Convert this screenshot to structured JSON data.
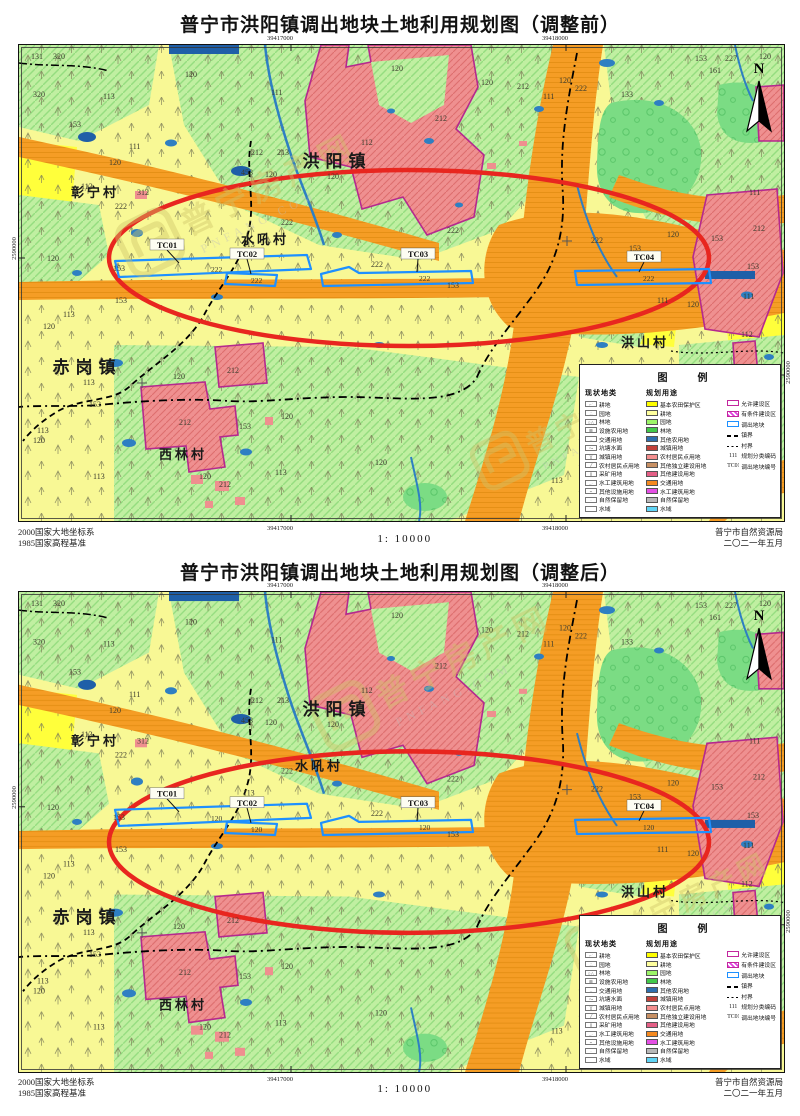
{
  "maps": [
    {
      "title": "普宁市洪阳镇调出地块土地利用规划图（调整前）",
      "variant": "before",
      "plot_label": "222"
    },
    {
      "title": "普宁市洪阳镇调出地块土地利用规划图（调整后）",
      "variant": "after",
      "plot_label": "120"
    }
  ],
  "footer": {
    "datum_line1": "2000国家大地坐标系",
    "datum_line2": "1985国家高程基准",
    "scale": "1:  10000",
    "agency_line1": "普宁市自然资源局",
    "agency_line2": "二〇二一年五月"
  },
  "coordinates": {
    "x_left": "39417000",
    "x_right": "39418000",
    "y_label": "2590000"
  },
  "compass": {
    "label": "N"
  },
  "watermark": {
    "cn": "普宁房产网",
    "en": "PNFANG.COM"
  },
  "legend": {
    "title": "图　例",
    "current_header": "现状地类",
    "current_items": [
      {
        "label": "耕地",
        "glyph": "⌐˙"
      },
      {
        "label": "园地",
        "glyph": "∴"
      },
      {
        "label": "林地",
        "glyph": "○△"
      },
      {
        "label": "设施农用地",
        "glyph": "⊞"
      },
      {
        "label": "交通用地",
        "glyph": "–"
      },
      {
        "label": "坑塘水面",
        "glyph": "〜"
      },
      {
        "label": "城镇用地",
        "glyph": "╳"
      },
      {
        "label": "农村居民点用地",
        "glyph": "╱"
      },
      {
        "label": "采矿用地",
        "glyph": "∥"
      },
      {
        "label": "水工建筑用地",
        "glyph": "–·"
      },
      {
        "label": "其他设施用地",
        "glyph": "⌁"
      },
      {
        "label": "自然保留地",
        "glyph": "·"
      },
      {
        "label": "水域",
        "glyph": ""
      }
    ],
    "planned_header": "规划用途",
    "planned_items": [
      {
        "label": "基本农田保护区",
        "color": "#ffff00"
      },
      {
        "label": "耕地",
        "color": "#ffff9e"
      },
      {
        "label": "园地",
        "color": "#9cf468"
      },
      {
        "label": "林地",
        "color": "#42c94a"
      },
      {
        "label": "其他农用地",
        "color": "#2e6fae"
      },
      {
        "label": "城镇用地",
        "color": "#c2413a"
      },
      {
        "label": "农村居民点用地",
        "color": "#f48f8f"
      },
      {
        "label": "其他独立建设用地",
        "color": "#c79064"
      },
      {
        "label": "其他建设用地",
        "color": "#e45f86"
      },
      {
        "label": "交通用地",
        "color": "#f58a20"
      },
      {
        "label": "水工建筑用地",
        "color": "#e44fe4"
      },
      {
        "label": "自然保留地",
        "color": "#b8b8b8"
      },
      {
        "label": "水域",
        "color": "#5fd4f5"
      }
    ],
    "zone_items": [
      {
        "label": "允许建设区",
        "swatch": "allowed"
      },
      {
        "label": "有条件建设区",
        "swatch": "conditional"
      },
      {
        "label": "调出地块",
        "swatch": "outplot"
      },
      {
        "label": "镇界",
        "swatch": "town-boundary"
      },
      {
        "label": "村界",
        "swatch": "village-boundary"
      },
      {
        "label": "规划分类编码",
        "swatch": "code",
        "code": "111"
      },
      {
        "label": "调出地块编号",
        "swatch": "code",
        "code": "TC01"
      }
    ]
  },
  "map_labels": {
    "towns": [
      {
        "text": "洪阳镇",
        "x": 318,
        "y": 122
      },
      {
        "text": "赤岗镇",
        "x": 68,
        "y": 328
      }
    ],
    "villages": [
      {
        "text": "彰宁村",
        "x": 76,
        "y": 152
      },
      {
        "text": "西林村",
        "x": 164,
        "y": 414
      },
      {
        "text": "洪山村",
        "x": 626,
        "y": 302
      }
    ],
    "shuihou": [
      {
        "text": "水吼村",
        "x": 246,
        "y": 199
      },
      {
        "text": "水吼村",
        "x": 300,
        "y": 177
      }
    ],
    "tc_labels": [
      {
        "text": "TC01",
        "x": 148,
        "y": 202,
        "lx": 160,
        "ly": 218
      },
      {
        "text": "TC02",
        "x": 228,
        "y": 211,
        "lx": 232,
        "ly": 229
      },
      {
        "text": "TC03",
        "x": 399,
        "y": 211,
        "lx": 398,
        "ly": 227
      },
      {
        "text": "TC04",
        "x": 625,
        "y": 214,
        "lx": 620,
        "ly": 227
      }
    ]
  },
  "map_annotations": [
    {
      "t": "131",
      "x": 12,
      "y": 14
    },
    {
      "t": "320",
      "x": 34,
      "y": 14
    },
    {
      "t": "320",
      "x": 14,
      "y": 52
    },
    {
      "t": "113",
      "x": 84,
      "y": 54
    },
    {
      "t": "153",
      "x": 50,
      "y": 82
    },
    {
      "t": "120",
      "x": 166,
      "y": 32
    },
    {
      "t": "111",
      "x": 110,
      "y": 104
    },
    {
      "t": "120",
      "x": 90,
      "y": 120
    },
    {
      "t": "111",
      "x": 252,
      "y": 50
    },
    {
      "t": "120",
      "x": 372,
      "y": 26
    },
    {
      "t": "120",
      "x": 462,
      "y": 40
    },
    {
      "t": "212",
      "x": 498,
      "y": 44
    },
    {
      "t": "111",
      "x": 524,
      "y": 54
    },
    {
      "t": "120",
      "x": 540,
      "y": 38
    },
    {
      "t": "222",
      "x": 556,
      "y": 46
    },
    {
      "t": "133",
      "x": 602,
      "y": 52
    },
    {
      "t": "153",
      "x": 676,
      "y": 16
    },
    {
      "t": "227",
      "x": 706,
      "y": 16
    },
    {
      "t": "161",
      "x": 690,
      "y": 28
    },
    {
      "t": "120",
      "x": 740,
      "y": 14
    },
    {
      "t": "111",
      "x": 730,
      "y": 150
    },
    {
      "t": "212",
      "x": 416,
      "y": 76
    },
    {
      "t": "112",
      "x": 342,
      "y": 100
    },
    {
      "t": "120",
      "x": 308,
      "y": 134
    },
    {
      "t": "212",
      "x": 232,
      "y": 110
    },
    {
      "t": "213",
      "x": 258,
      "y": 110
    },
    {
      "t": "453",
      "x": 222,
      "y": 130
    },
    {
      "t": "120",
      "x": 246,
      "y": 132
    },
    {
      "t": "312",
      "x": 118,
      "y": 150
    },
    {
      "t": "113",
      "x": 62,
      "y": 144
    },
    {
      "t": "222",
      "x": 96,
      "y": 164
    },
    {
      "t": "120",
      "x": 28,
      "y": 216
    },
    {
      "t": "113",
      "x": 224,
      "y": 202
    },
    {
      "t": "222",
      "x": 262,
      "y": 180
    },
    {
      "t": "222",
      "x": 352,
      "y": 222
    },
    {
      "t": "222",
      "x": 428,
      "y": 188
    },
    {
      "t": "222",
      "x": 572,
      "y": 198
    },
    {
      "t": "120",
      "x": 648,
      "y": 192
    },
    {
      "t": "153",
      "x": 692,
      "y": 196
    },
    {
      "t": "153",
      "x": 610,
      "y": 206
    },
    {
      "t": "212",
      "x": 734,
      "y": 186
    },
    {
      "t": "153",
      "x": 728,
      "y": 224
    },
    {
      "t": "111",
      "x": 724,
      "y": 254
    },
    {
      "t": "111",
      "x": 638,
      "y": 258
    },
    {
      "t": "120",
      "x": 668,
      "y": 262
    },
    {
      "t": "112",
      "x": 722,
      "y": 292
    },
    {
      "t": "153",
      "x": 94,
      "y": 226
    },
    {
      "t": "153",
      "x": 96,
      "y": 258
    },
    {
      "t": "113",
      "x": 44,
      "y": 272
    },
    {
      "t": "120",
      "x": 24,
      "y": 284
    },
    {
      "t": "212",
      "x": 208,
      "y": 328
    },
    {
      "t": "120",
      "x": 154,
      "y": 334
    },
    {
      "t": "113",
      "x": 64,
      "y": 340
    },
    {
      "t": "153",
      "x": 70,
      "y": 362
    },
    {
      "t": "212",
      "x": 160,
      "y": 380
    },
    {
      "t": "120",
      "x": 262,
      "y": 374
    },
    {
      "t": "153",
      "x": 220,
      "y": 384
    },
    {
      "t": "113",
      "x": 18,
      "y": 388
    },
    {
      "t": "120",
      "x": 14,
      "y": 398
    },
    {
      "t": "113",
      "x": 74,
      "y": 434
    },
    {
      "t": "120",
      "x": 180,
      "y": 434
    },
    {
      "t": "212",
      "x": 200,
      "y": 442
    },
    {
      "t": "113",
      "x": 256,
      "y": 430
    },
    {
      "t": "120",
      "x": 356,
      "y": 420
    },
    {
      "t": "153",
      "x": 428,
      "y": 243
    },
    {
      "t": "113",
      "x": 532,
      "y": 438
    }
  ]
}
